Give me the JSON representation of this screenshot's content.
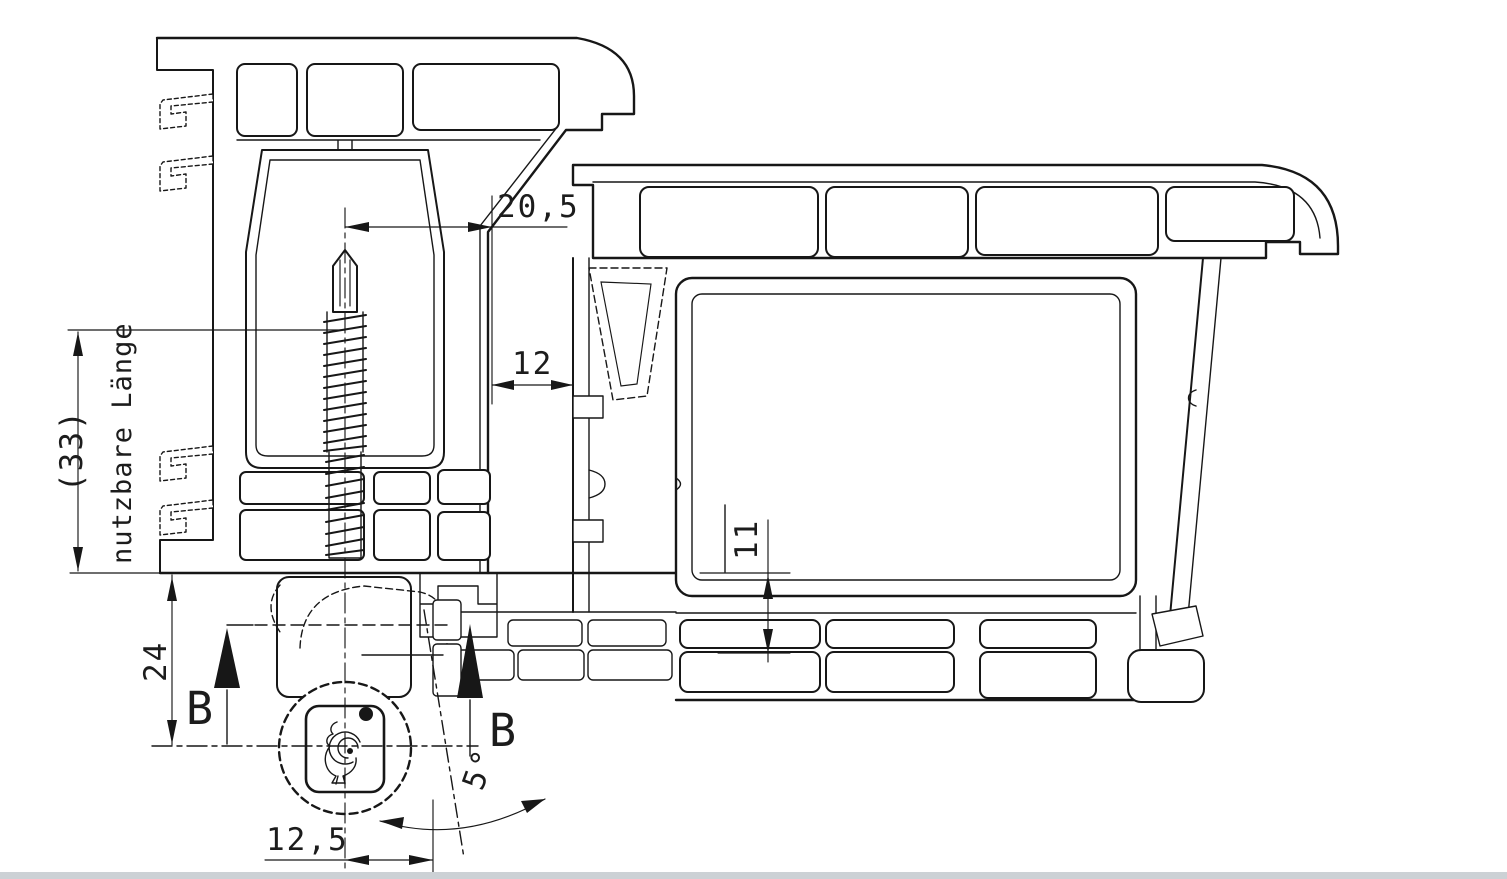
{
  "drawing": {
    "title": "window-frame-hinge-section",
    "dimensions": {
      "screw_offset": "20,5",
      "rebate_gap": "12",
      "overlap_height": "11",
      "hinge_axis_distance": "24",
      "roller_offset": "12,5",
      "tilt_angle": "5°",
      "usable_length_value": "(33)",
      "usable_length_label": "nutzbare Länge"
    },
    "section_markers": {
      "b": "B"
    },
    "colors": {
      "line": "#171717",
      "background": "#ffffff",
      "bottom_strip": "#ccd1d5"
    },
    "icons": {
      "hinge_logo": "rooster-logo"
    }
  }
}
